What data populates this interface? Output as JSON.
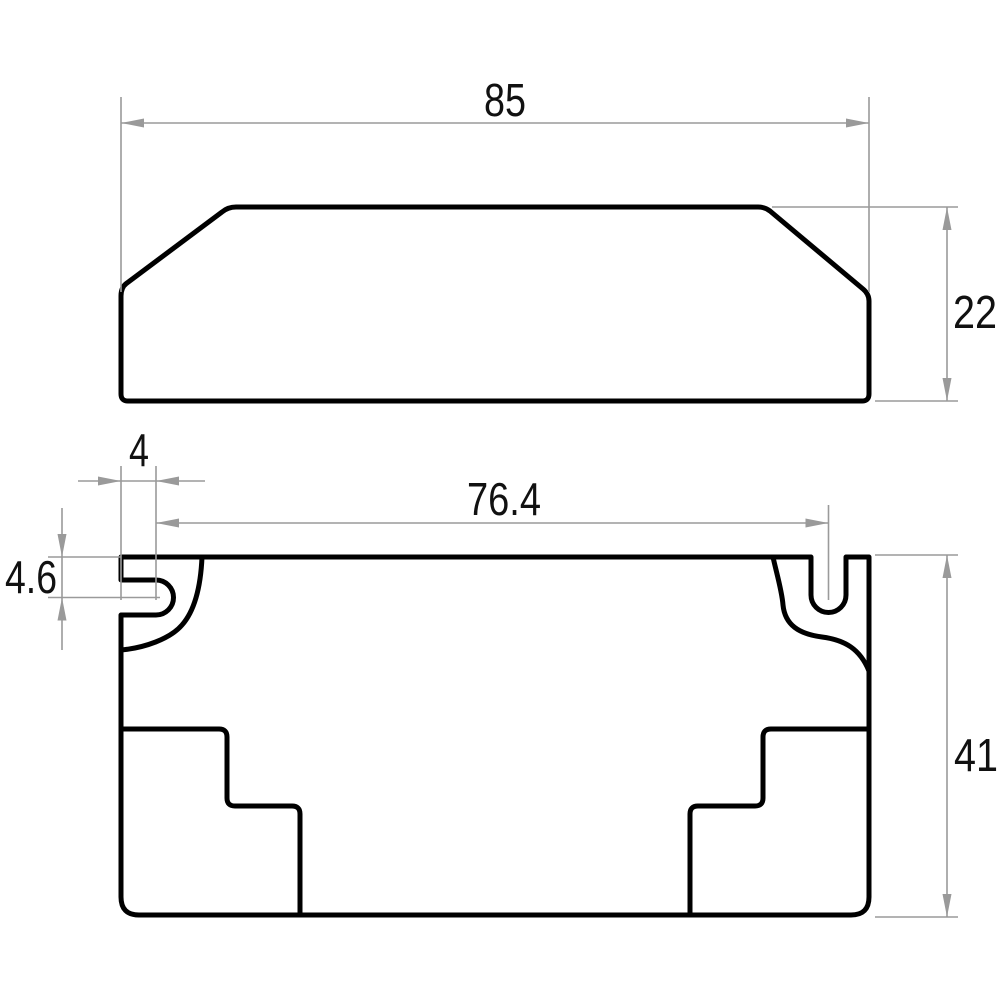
{
  "drawing": {
    "type": "2D engineering dimension drawing, two orthographic views of an enclosure",
    "colors": {
      "outline": "#000000",
      "dimension_lines": "#9a9a9a",
      "text": "#111111",
      "background": "#ffffff"
    },
    "visible_values": {
      "overall_length": "85",
      "overall_height": "22",
      "overall_width": "41",
      "slot_center_spacing": "76.4",
      "slot_center_from_end": "4",
      "slot_center_from_side": "4.6"
    }
  },
  "views": {
    "side_view": {
      "outline": "M 128,401 Q 121,401 121,394 L 121,296 Q 121,287 127,283 L 222,212 Q 228,207 236,207 L 758,207 Q 765,207 770,211 L 863,289 Q 869,294 869,301 L 869,394 Q 869,401 862,401 Z"
    },
    "bottom_view": {
      "outline": "M 121,557 L 811,557 L 811,595 A 17.5 17.5 0 0 0 846,595 L 846,557 L 869,557 L 869,897 Q 869,915 851,915 L 139,915 Q 121,915 121,897 L 121,615 L 156,615 A 17.5 17.5 0 0 0 156,580 L 121,580 Z",
      "left_slot_boss": "M 202,557 C 201,580 197,608 182,625 C 170,639 144,648 121,650",
      "right_slot_boss": "M 773,557 C 776,571 782,591 783,605 C 785,625 799,634 822,637 C 845,640 860,649 869,671",
      "left_step_cutout": "M 121,729 L 219,729 Q 227,729 227,737 L 227,798 Q 227,806 235,806 L 292,806 Q 300,806 300,814 L 300,915",
      "right_step_cutout": "M 869,729 L 771,729 Q 763,729 763,737 L 763,798 Q 763,806 755,806 L 698,806 Q 690,806 690,814 L 690,915"
    }
  },
  "dimensions": [
    {
      "label": "85",
      "ext": "M 121,97 L 121,292 M 869,97 L 869,292",
      "line": "M 121,123 L 869,123",
      "arrows": "M 121,123 L 144,118.5 L 144,127.5 Z M 869,123 L 846,118.5 L 846,127.5 Z",
      "text_transform": "translate(505,116)"
    },
    {
      "label": "22",
      "ext": "M 772,207 L 958,207 M 875,401 L 958,401",
      "line": "M 947,207 L 947,401",
      "arrows": "M 947,207 L 942.5,230 L 951.5,230 Z M 947,401 L 942.5,378 L 951.5,378 Z",
      "text_transform": "translate(953,328)"
    },
    {
      "label": "4",
      "ext": "M 121,466 L 121,600 M 156,466 L 156,600",
      "line": "M 78,481 L 205,481",
      "arrows": "M 121,481 L 98,476.5 L 98,485.5 Z M 156,481 L 179,476.5 L 179,485.5 Z",
      "text_transform": "translate(139,466)"
    },
    {
      "label": "76.4",
      "ext": "M 828.5,505 L 828.5,600",
      "line": "M 156,523 L 828.5,523",
      "arrows": "M 156,523 L 179,518.5 L 179,527.5 Z M 828.5,523 L 805.5,518.5 L 805.5,527.5 Z",
      "text_transform": "translate(504,515)"
    },
    {
      "label": "4.6",
      "ext": "M 48,557 L 121,557 M 48,597.5 L 160,597.5",
      "line": "M 62,508 L 62,650",
      "arrows": "M 62,557 L 57.5,534 L 66.5,534 Z M 62,597.5 L 57.5,620.5 L 66.5,620.5 Z",
      "text_transform": "translate(57,593)"
    },
    {
      "label": "41",
      "ext": "M 875,555 L 958,555 M 875,917 L 958,917",
      "line": "M 947,555 L 947,917",
      "arrows": "M 947,555 L 942.5,578 L 951.5,578 Z M 947,917 L 942.5,894 L 951.5,894 Z",
      "text_transform": "translate(954,771)"
    }
  ]
}
